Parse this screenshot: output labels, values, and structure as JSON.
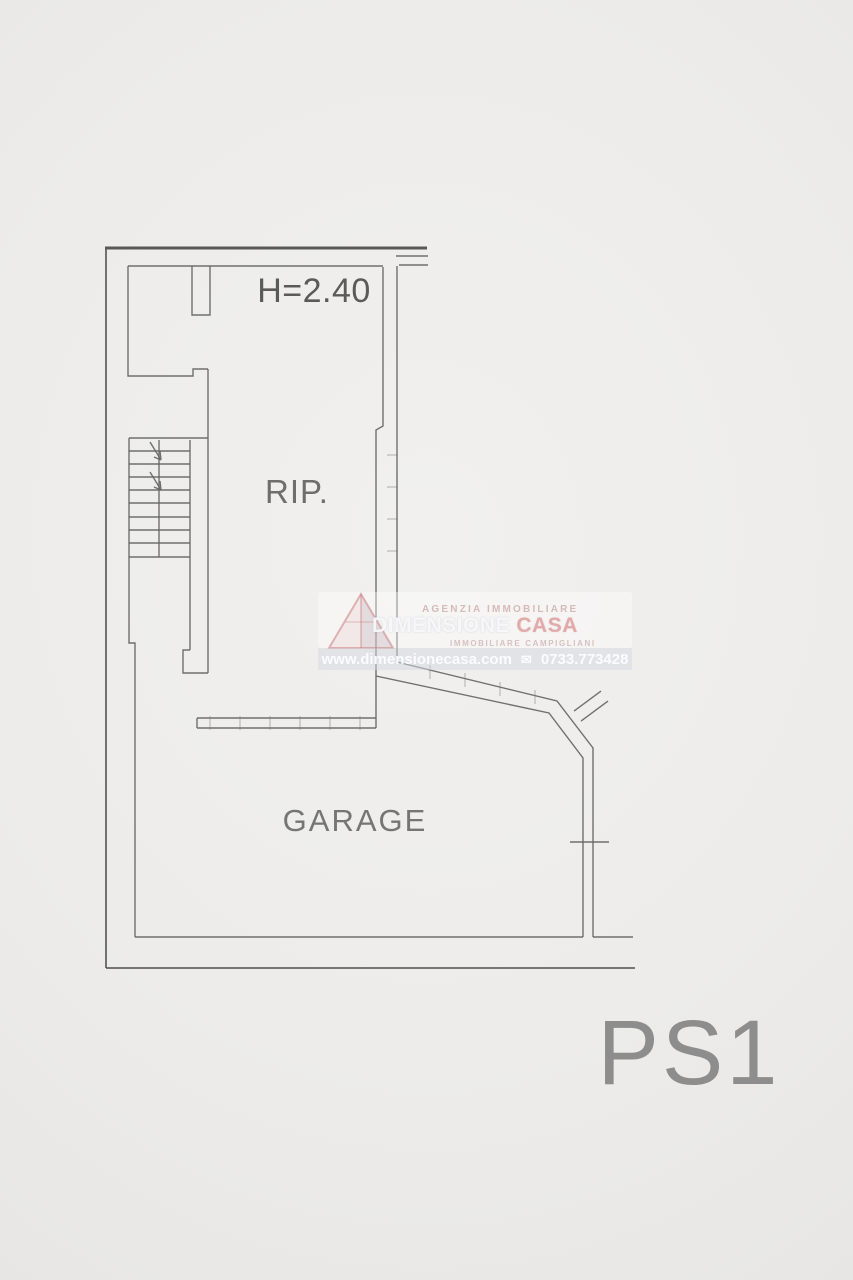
{
  "plan": {
    "height_label": "H=2.40",
    "rip_label": "RIP.",
    "garage_label": "GARAGE",
    "floor_label": "PS1"
  },
  "watermark": {
    "agency_type": "AGENZIA IMMOBILIARE",
    "agency_name_primary": "DIMENSIONE",
    "agency_name_accent": "CASA",
    "subtitle": "IMMOBILIARE CAMPIGLIANI",
    "website": "www.dimensionecasa.com",
    "envelope_icon": "✉",
    "phone": "0733.773428"
  },
  "colors": {
    "background": "#edecea",
    "wall_line": "#656565",
    "heavy_wall_line": "#4b4b4b",
    "label_text": "#6e6e6e",
    "floor_label_text": "#8d8d8d",
    "watermark_pink": "#dfa4a4",
    "watermark_bar": "#d3d7df"
  }
}
